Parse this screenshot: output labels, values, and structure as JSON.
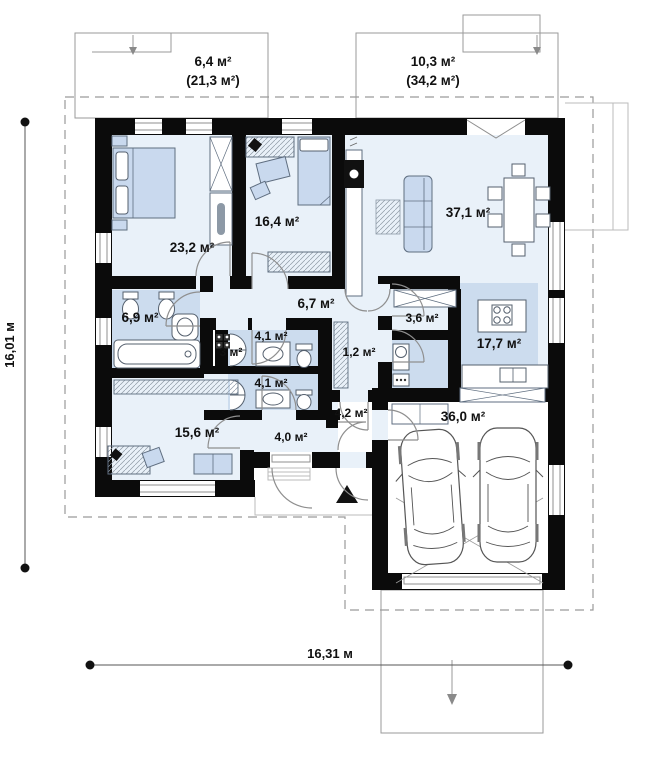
{
  "plan": {
    "type": "house-floor-plan",
    "terraces": {
      "left": {
        "area": "6,4 м²",
        "total": "(21,3 м²)"
      },
      "right": {
        "area": "10,3 м²",
        "total": "(34,2 м²)"
      }
    },
    "rooms": {
      "bedroom_main": {
        "area": "23,2 м²"
      },
      "bedroom_second": {
        "area": "16,4 м²"
      },
      "living_room": {
        "area": "37,1 м²"
      },
      "bathroom": {
        "area": "6,9 м²"
      },
      "hall": {
        "area": "3 м²"
      },
      "wc_top": {
        "area": "4,1 м²"
      },
      "wc_bottom": {
        "area": "4,1 м²"
      },
      "corridor": {
        "area": "6,7 м²"
      },
      "wardrobe": {
        "area": "1,2 м²"
      },
      "pantry": {
        "area": "3,6 м²"
      },
      "kitchen": {
        "area": "17,7 м²"
      },
      "vestibule": {
        "area": "4,2 м²"
      },
      "entry": {
        "area": "4,0 м²"
      },
      "bedroom_third": {
        "area": "15,6 м²"
      },
      "garage": {
        "area": "36,0 м²"
      }
    },
    "dimensions": {
      "height_label": "16,01 м",
      "width_label": "16,31 м"
    },
    "colors": {
      "wall": "#0b0b0b",
      "floor_light": "#e9f1f9",
      "floor_wet": "#ccdcee",
      "furniture": "#c9d9ee",
      "outline": "#9a9a9a"
    }
  }
}
